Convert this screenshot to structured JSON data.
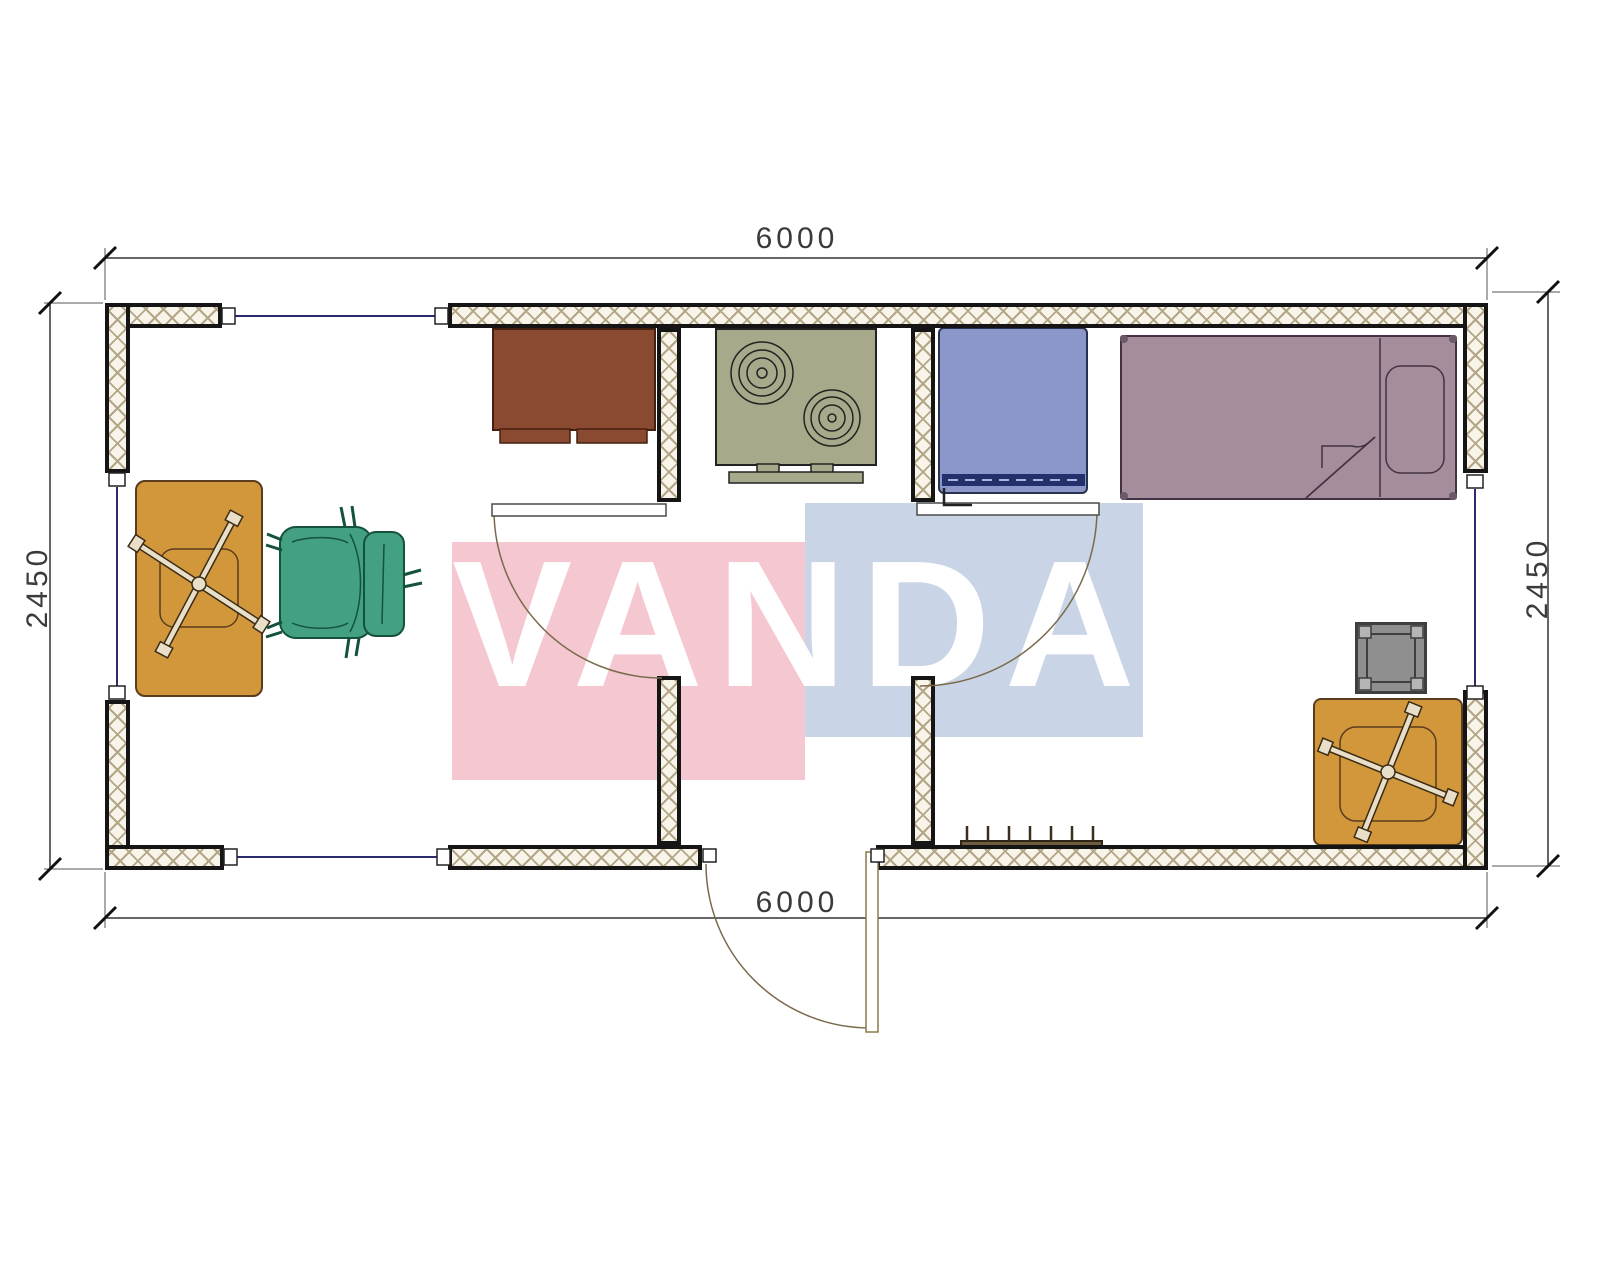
{
  "watermark": {
    "text": "VANDA"
  },
  "dimensions": {
    "top": "6000",
    "bottom": "6000",
    "left": "2450",
    "right": "2450"
  },
  "colors": {
    "watermark_pink": "#f5c8d1",
    "watermark_blue": "#c9d5e6",
    "wall_hatch_line": "#b3a687",
    "wall_fill": "#f8f4ea",
    "cabinet_brown": "#8a4a31",
    "stove_olive": "#a7a98a",
    "washer_blue": "#8b97c9",
    "bed_mauve": "#a58d9b",
    "chair_green": "#43a083",
    "stool_gray": "#8f8f8f",
    "table_tan": "#d2973b",
    "radiator_brown": "#6f5d3f",
    "window_line": "#2b2b6b",
    "dimension_line": "#333333"
  },
  "furniture": [
    "kitchen-cabinet",
    "stove",
    "washing-machine",
    "bed",
    "bedside-stool",
    "pedestal-table",
    "desk-table",
    "office-chair",
    "radiator"
  ]
}
